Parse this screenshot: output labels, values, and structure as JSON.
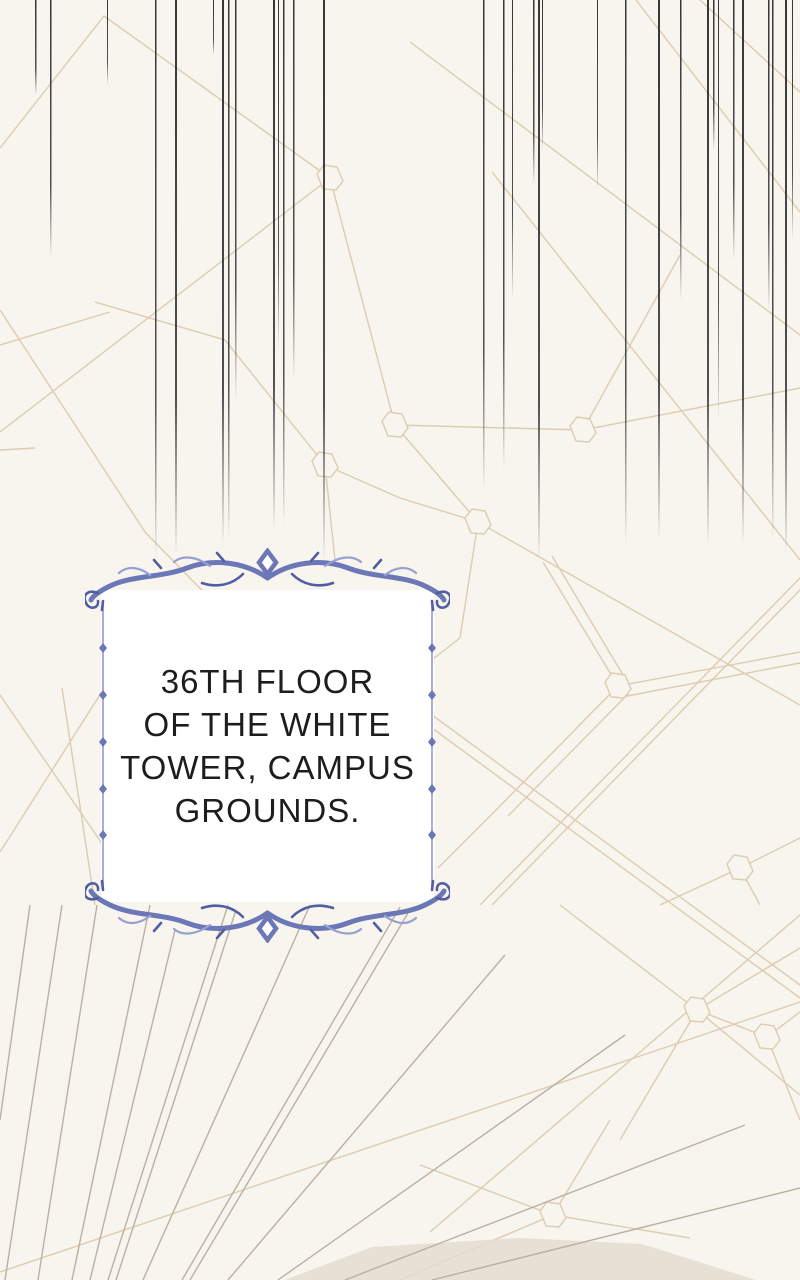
{
  "panel": {
    "type": "webtoon-narration-panel"
  },
  "caption": {
    "text": "36TH FLOOR OF THE WHITE TOWER, CAMPUS GROUNDS.",
    "lines": [
      "36TH FLOOR",
      "OF THE WHITE",
      "TOWER, CAMPUS",
      "GROUNDS."
    ]
  },
  "decorations": {
    "frame_style": "ornate-blue-vine-frame",
    "top_ornament": "symmetric-vine-flourish-with-diamond",
    "bottom_ornament": "mirrored-vine-flourish-with-diamond",
    "background_pattern": "tan-geometric-web-with-hexagon-nodes",
    "bottom_left_pattern": "grey-fan-radiating-lines",
    "top_pattern": "dark-vertical-speed-lines"
  },
  "colors": {
    "background": "#f8f4ee",
    "box": "#ffffff",
    "text": "#1d1d20",
    "frame": "#6b77b6",
    "frameDark": "#515ea1",
    "frameLight": "#98a1d0",
    "web": "#dbccb2",
    "fan": "#bbb1a1",
    "speed": "#26262a",
    "shade": "#e3dcd0"
  }
}
